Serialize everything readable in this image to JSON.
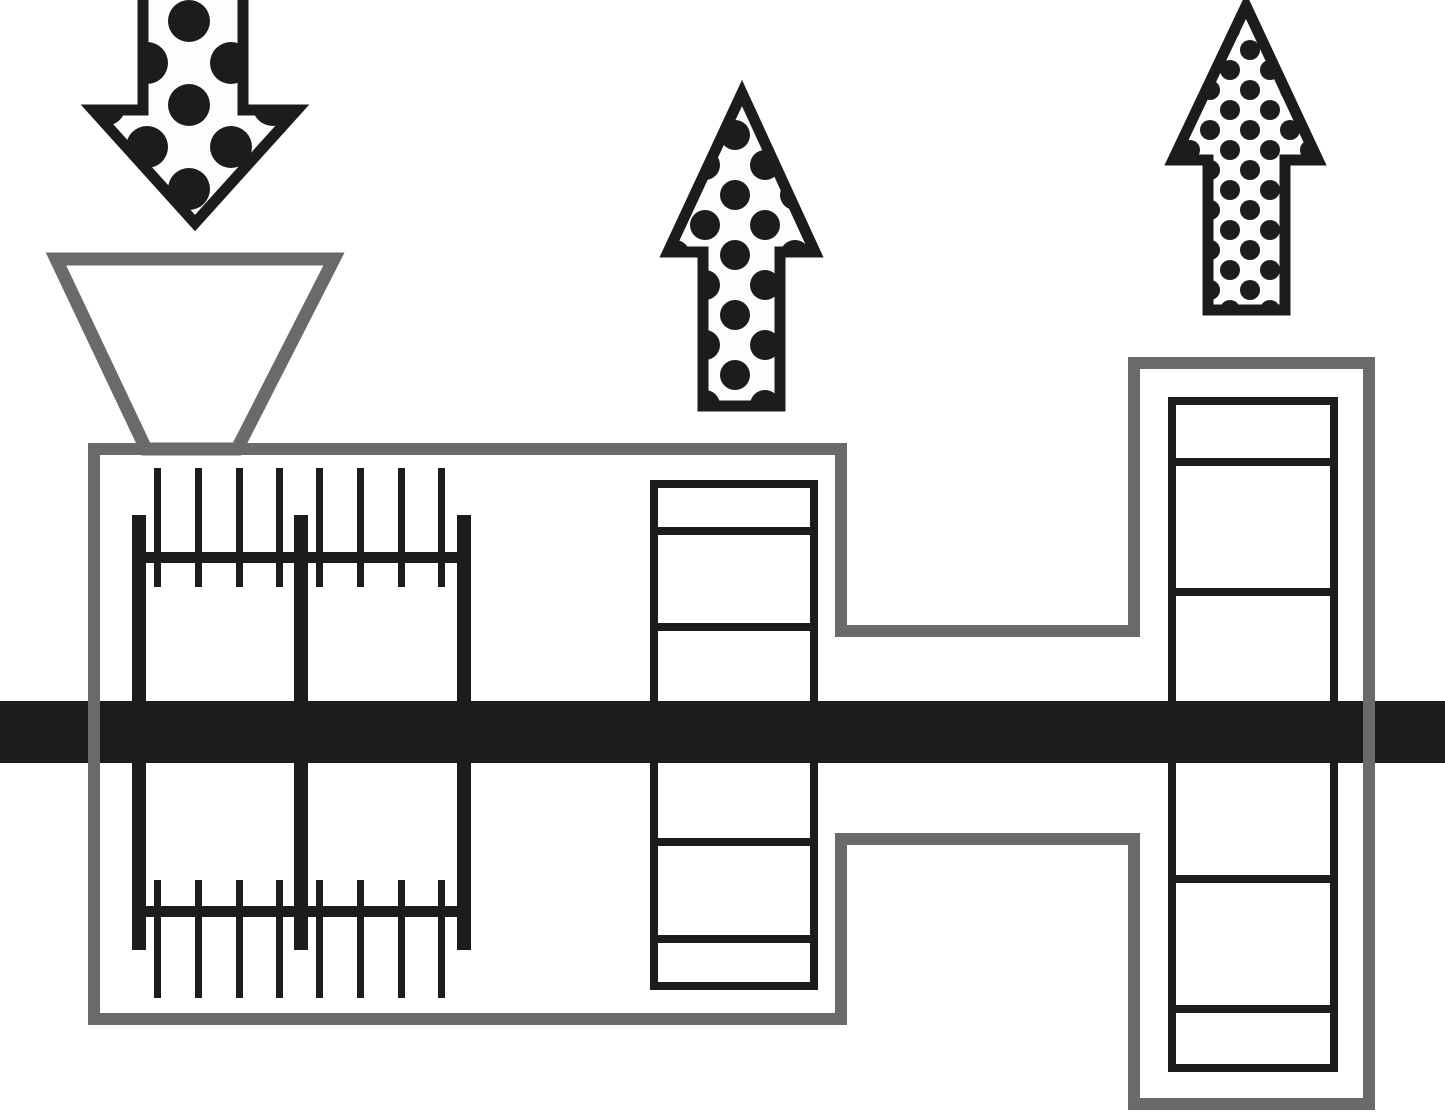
{
  "diagram": {
    "kind": "process-schematic",
    "description": "Schematic of a horizontal mixing/devolatilizing machine: a dotted feed arrow enters a hopper on a pin-agitator chamber; a shaft runs through segmented screw blocks; a transfer channel leads to a second vent chamber; two dotted vapor arrows point upward.",
    "colors": {
      "ink": "#1c1c1c",
      "outline_gray": "#6a6a6a",
      "arrow_fill": "#fdfdfd",
      "background": "#ffffff"
    },
    "arrows": {
      "feed": {
        "direction": "down",
        "dot_pattern": "large-dots"
      },
      "vent_left": {
        "direction": "up",
        "dot_pattern": "medium-dots"
      },
      "vent_right": {
        "direction": "up",
        "dot_pattern": "small-dots"
      }
    },
    "components": {
      "hopper": "feed-hopper",
      "chamber_left": "pin-mixer-chamber",
      "pin_comb_top": "upper-pin-comb",
      "pin_comb_bottom": "lower-pin-comb",
      "block_middle": "segmented-screw-block",
      "channel": "transfer-channel",
      "chamber_right": "vent-chamber",
      "block_right": "segmented-screw-block",
      "shaft": "rotor-shaft"
    }
  }
}
